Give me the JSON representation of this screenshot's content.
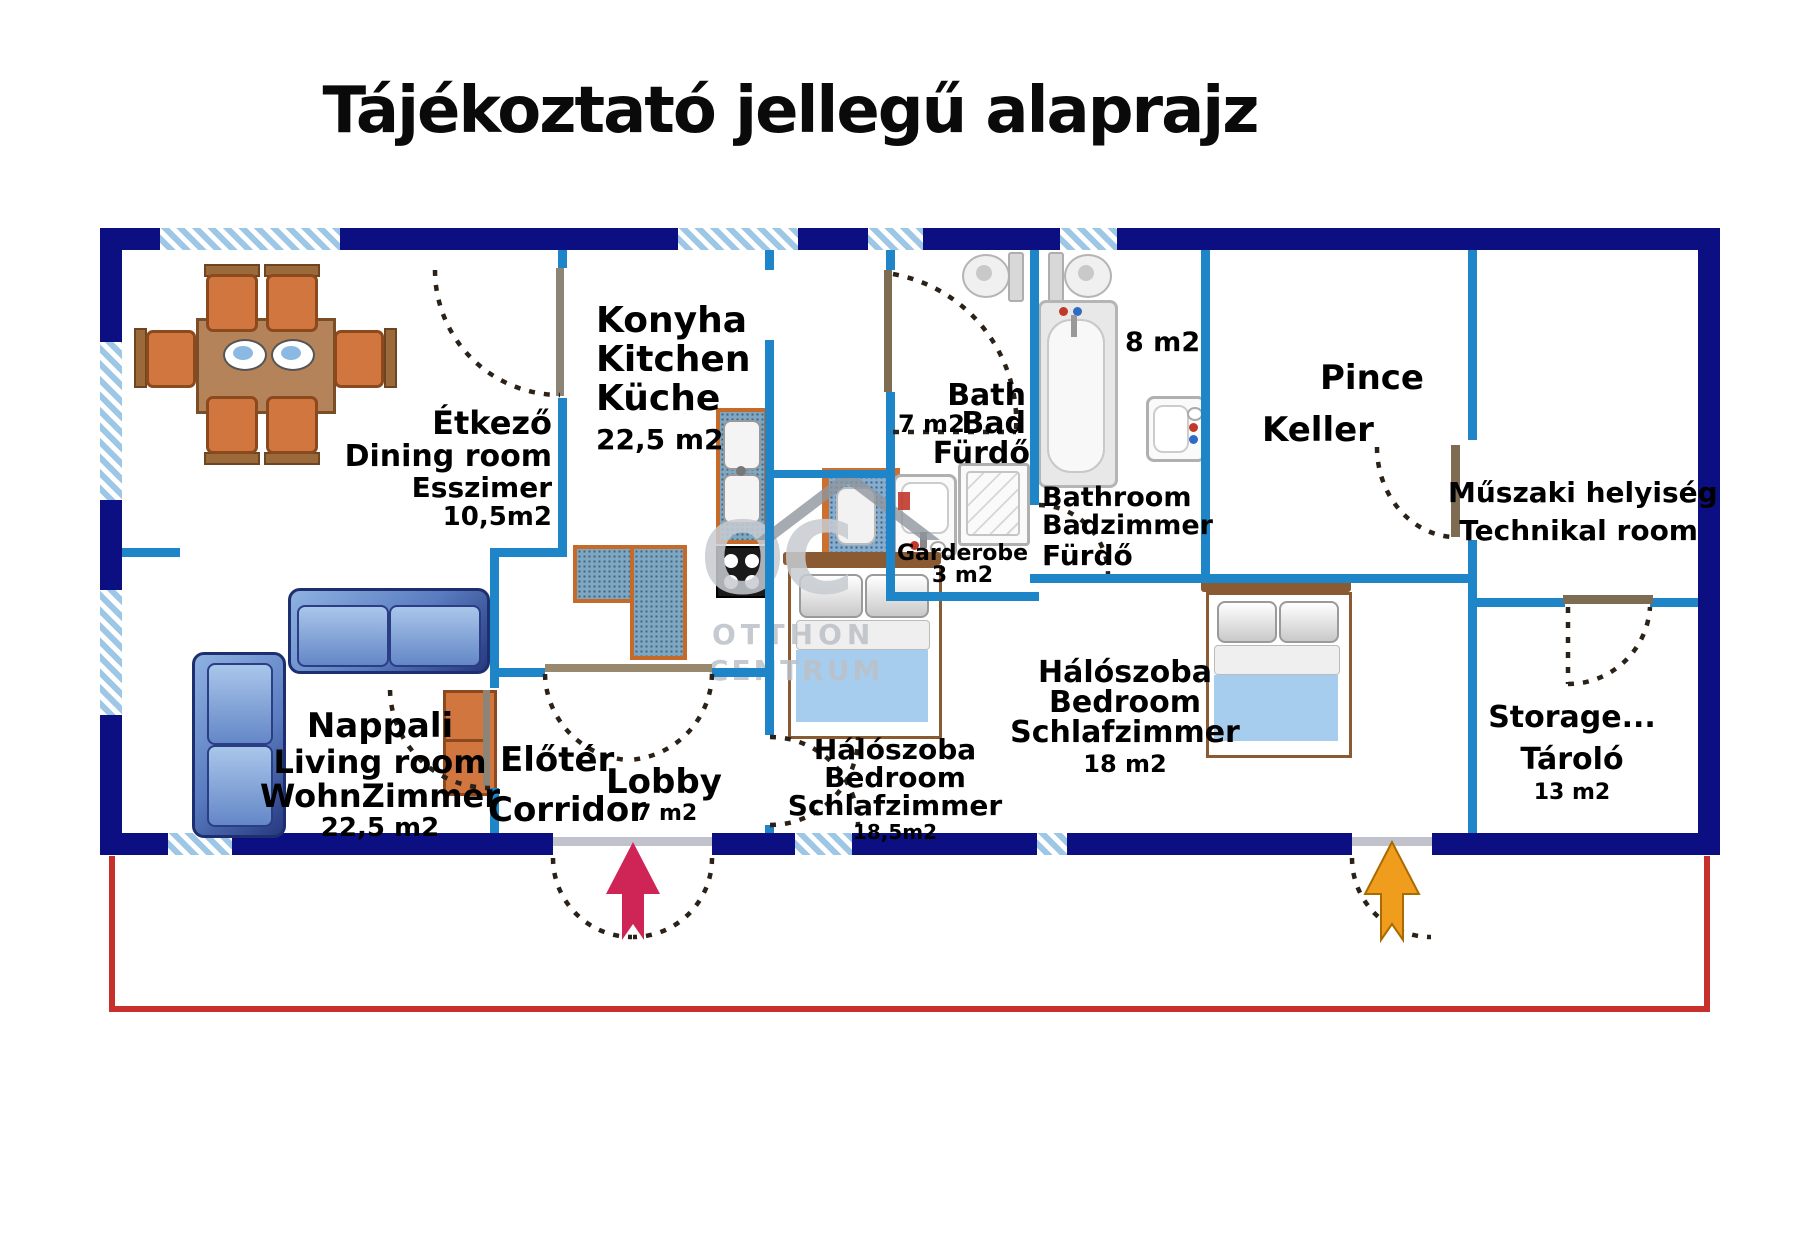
{
  "title": "Tájékoztató jellegű alaprajz",
  "watermark": {
    "monogram": "OC",
    "line1": "OTTHON",
    "line2": "CENTRUM"
  },
  "rooms": {
    "dining": {
      "name_hu": "Étkező",
      "name_en": "Dining room",
      "name_de": "Esszimer",
      "area": "10,5m2"
    },
    "kitchen": {
      "name_hu": "Konyha",
      "name_en": "Kitchen",
      "name_de": "Küche",
      "area": "22,5 m2"
    },
    "living": {
      "name_hu": "Nappali",
      "name_en": "Living room",
      "name_de": "WohnZimmer",
      "area": "22,5 m2"
    },
    "lobby": {
      "name_hu": "Előtér",
      "name_en": "Lobby",
      "name_alt": "Corridor",
      "area": "7 m2"
    },
    "bath": {
      "name_en": "Bath",
      "area": "7 m2",
      "name_de": "Bad",
      "name_hu": "Fürdő"
    },
    "garderobe": {
      "name": "Garderobe",
      "area": "3 m2"
    },
    "bathroom": {
      "area": "8 m2",
      "name_en": "Bathroom",
      "name_de": "Badzimmer",
      "name_hu": "Fürdő"
    },
    "cellar": {
      "name_hu": "Pince",
      "name_de": "Keller"
    },
    "technical": {
      "name_hu": "Műszaki helyiség",
      "name_en": "Technikal room"
    },
    "bedroom1": {
      "name_hu": "Hálószoba",
      "name_en": "Bedroom",
      "name_de": "Schlafzimmer",
      "area": "18,5m2"
    },
    "bedroom2": {
      "name_hu": "Hálószoba",
      "name_en": "Bedroom",
      "name_de": "Schlafzimmer",
      "area": "18 m2"
    },
    "storage": {
      "name_en": "Storage...",
      "name_hu": "Tároló",
      "area": "13 m2"
    }
  },
  "colors": {
    "outer_wall": "#0b0f82",
    "inner_wall": "#1e86c8",
    "window_hatch": "#9ec7e6",
    "boundary_red": "#c8302c",
    "entrance_arrow_main": "#cf2456",
    "entrance_arrow_secondary": "#f09c1c"
  }
}
